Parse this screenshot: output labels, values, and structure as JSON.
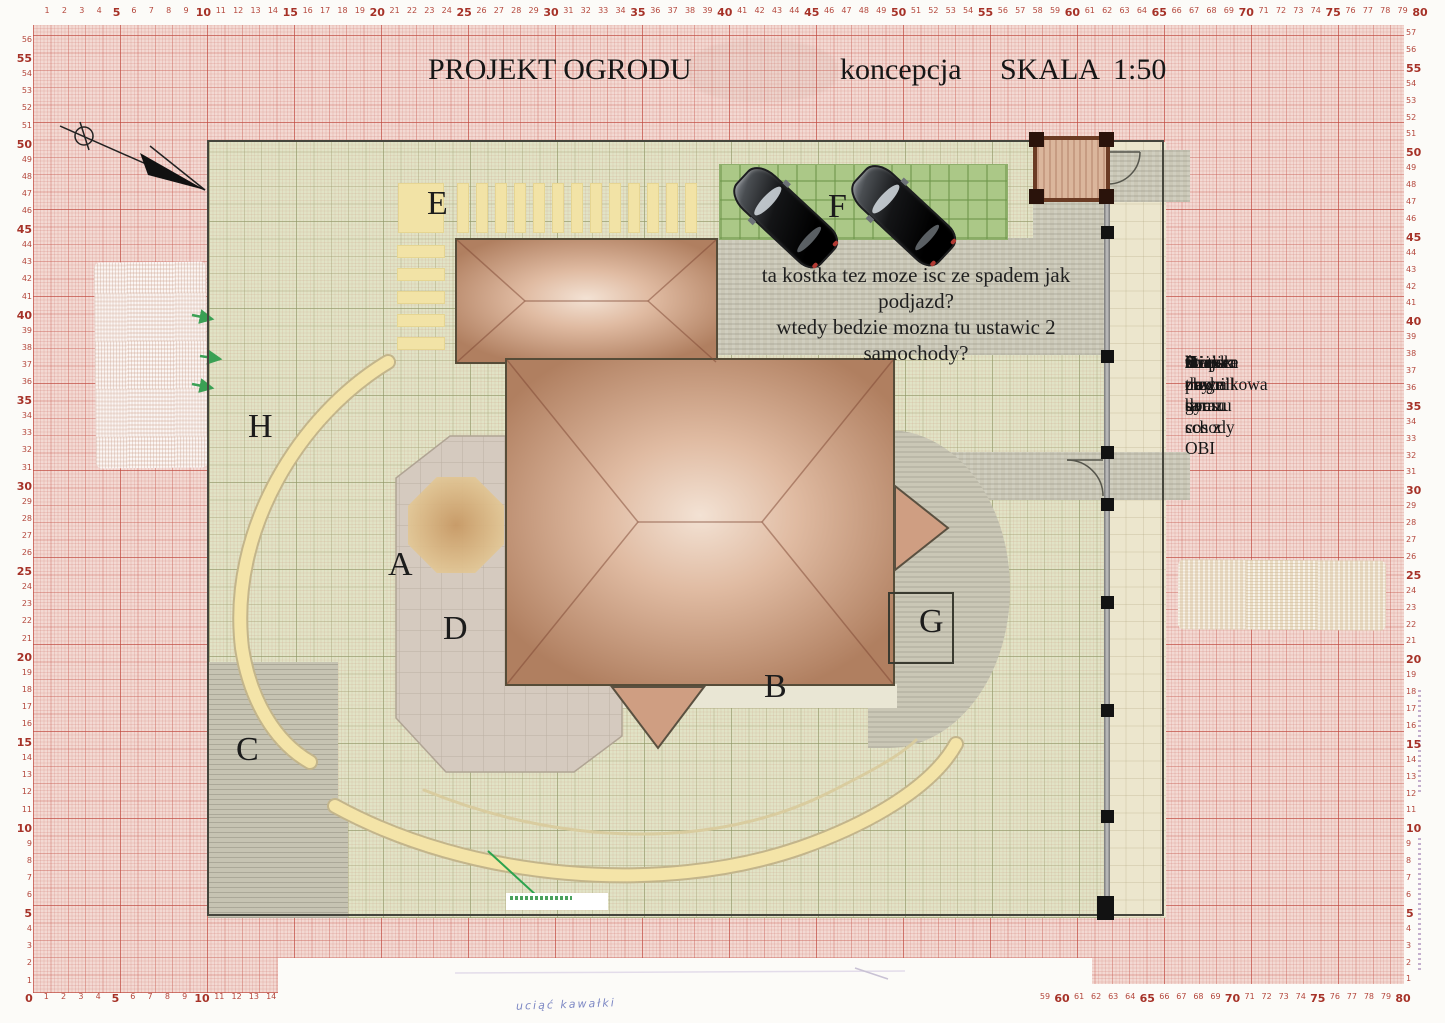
{
  "page": {
    "title": "PROJEKT OGRODU",
    "subtitle": "koncepcja",
    "scale_label": "SKALA",
    "scale_value": "1:50"
  },
  "annotation": {
    "line1": "ta kostka tez moze isc ze spadem jak podjazd?",
    "line2": "wtedy bedzie mozna tu ustawic 2 samochody?"
  },
  "legend": {
    "items": [
      {
        "key": "A",
        "label": "Stopien z tarasu"
      },
      {
        "key": "B",
        "label": "żwirek przy domu"
      },
      {
        "key": "C",
        "label": "miejsce na grill"
      },
      {
        "key": "D",
        "label": "taras"
      },
      {
        "key": "E",
        "label": "ściezka do garazu"
      },
      {
        "key": "F",
        "label": "kratka trawnikowa"
      },
      {
        "key": "G",
        "label": "tu chyba sa schody"
      },
      {
        "key": "H",
        "label": "tu moze byc cos z OBI"
      }
    ]
  },
  "plan_labels": {
    "A": "A",
    "B": "B",
    "C": "C",
    "D": "D",
    "E": "E",
    "F": "F",
    "G": "G",
    "H": "H"
  },
  "handwriting": "uciąć kawałki",
  "rulers": {
    "top": {
      "start": 1,
      "end": 80
    },
    "left": {
      "start": 56,
      "end": 1
    },
    "right": {
      "start": 57,
      "end": 1
    },
    "bottom_left": {
      "start": 0,
      "end": 14
    },
    "bottom_right": {
      "start": 59,
      "end": 80
    },
    "bold_every": 5
  },
  "colors": {
    "grid_red": "#c44d42",
    "lawn_green": "#e1e3c6",
    "path_yellow": "#f3e3a7",
    "paving_gray": "#cac7b6",
    "parking_green": "#abc887",
    "roof_brown": "#b9805f",
    "car_black": "#0c0d0e",
    "marker_green": "#2ea34e"
  }
}
